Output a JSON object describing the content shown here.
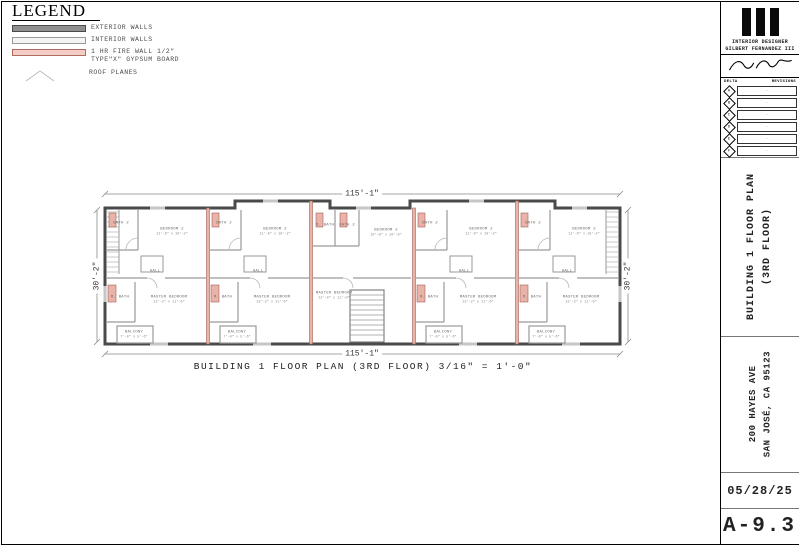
{
  "legend": {
    "title": "LEGEND",
    "items": [
      {
        "swatch": "exterior",
        "label": "EXTERIOR WALLS",
        "label2": ""
      },
      {
        "swatch": "interior",
        "label": "INTERIOR WALLS",
        "label2": ""
      },
      {
        "swatch": "firewall",
        "label": "1 HR FIRE WALL 1/2\"",
        "label2": "TYPE\"X\" GYPSUM BOARD"
      },
      {
        "swatch": "roof",
        "label": "ROOF PLANES",
        "label2": ""
      }
    ]
  },
  "plan": {
    "dim_top": "115'-1\"",
    "dim_bottom": "115'-1\"",
    "dim_left": "30'-2\"",
    "dim_right": "30'-2\"",
    "caption": "BUILDING 1 FLOOR PLAN (3RD FLOOR) 3/16\" = 1'-0\"",
    "rooms": [
      {
        "label": "BATH 2",
        "dim": "",
        "x": 33,
        "y": 38
      },
      {
        "label": "BEDROOM 2",
        "dim": "11'-6\" x 10'-2\"",
        "x": 84,
        "y": 46
      },
      {
        "label": "HALL",
        "dim": "",
        "x": 67,
        "y": 86
      },
      {
        "label": "M. BATH",
        "dim": "",
        "x": 32,
        "y": 112
      },
      {
        "label": "MASTER BEDROOM",
        "dim": "13'-2\" x 11'-6\"",
        "x": 81,
        "y": 114
      },
      {
        "label": "BALCONY",
        "dim": "7'-0\" x 5'-6\"",
        "x": 46,
        "y": 149
      },
      {
        "label": "BATH 2",
        "dim": "",
        "x": 136,
        "y": 38
      },
      {
        "label": "BEDROOM 2",
        "dim": "11'-6\" x 10'-2\"",
        "x": 187,
        "y": 46
      },
      {
        "label": "HALL",
        "dim": "",
        "x": 170,
        "y": 86
      },
      {
        "label": "M. BATH",
        "dim": "",
        "x": 135,
        "y": 112
      },
      {
        "label": "MASTER BEDROOM",
        "dim": "13'-2\" x 11'-6\"",
        "x": 184,
        "y": 114
      },
      {
        "label": "BALCONY",
        "dim": "7'-0\" x 5'-6\"",
        "x": 149,
        "y": 149
      },
      {
        "label": "M. BATH",
        "dim": "",
        "x": 237,
        "y": 40
      },
      {
        "label": "BATH 2",
        "dim": "",
        "x": 259,
        "y": 40
      },
      {
        "label": "BEDROOM 2",
        "dim": "10'-8\" x 10'-0\"",
        "x": 298,
        "y": 47
      },
      {
        "label": "MASTER BEDROOM",
        "dim": "12'-0\" x 11'-0\"",
        "x": 246,
        "y": 110
      },
      {
        "label": "BATH 2",
        "dim": "",
        "x": 342,
        "y": 38
      },
      {
        "label": "BEDROOM 2",
        "dim": "11'-6\" x 10'-2\"",
        "x": 393,
        "y": 46
      },
      {
        "label": "HALL",
        "dim": "",
        "x": 376,
        "y": 86
      },
      {
        "label": "M. BATH",
        "dim": "",
        "x": 341,
        "y": 112
      },
      {
        "label": "MASTER BEDROOM",
        "dim": "13'-2\" x 11'-6\"",
        "x": 390,
        "y": 114
      },
      {
        "label": "BALCONY",
        "dim": "7'-0\" x 5'-6\"",
        "x": 355,
        "y": 149
      },
      {
        "label": "BATH 2",
        "dim": "",
        "x": 445,
        "y": 38
      },
      {
        "label": "BEDROOM 2",
        "dim": "11'-6\" x 10'-2\"",
        "x": 496,
        "y": 46
      },
      {
        "label": "HALL",
        "dim": "",
        "x": 479,
        "y": 86
      },
      {
        "label": "M. BATH",
        "dim": "",
        "x": 444,
        "y": 112
      },
      {
        "label": "MASTER BEDROOM",
        "dim": "13'-2\" x 11'-6\"",
        "x": 493,
        "y": 114
      },
      {
        "label": "BALCONY",
        "dim": "7'-0\" x 5'-6\"",
        "x": 458,
        "y": 149
      }
    ]
  },
  "titleblock": {
    "firm_line1": "INTERIOR DESIGNER",
    "firm_line2": "GILBERT FERNANDEZ III",
    "delta_header": "DELTA",
    "revisions_header": "REVISIONS",
    "revision_rows": [
      {
        "letter": "A",
        "note": "-"
      },
      {
        "letter": "B",
        "note": "-"
      },
      {
        "letter": "C",
        "note": "-"
      },
      {
        "letter": "D",
        "note": "-"
      },
      {
        "letter": "E",
        "note": "-"
      },
      {
        "letter": "F",
        "note": "-"
      }
    ],
    "sheet_title_line1": "BUILDING 1 FLOOR PLAN",
    "sheet_title_line2": "(3RD FLOOR)",
    "address_line1": "200 HAYES AVE",
    "address_line2": "SAN JOSÉ, CA 95123",
    "date": "05/28/25",
    "sheet_number": "A-9.3"
  },
  "colors": {
    "exterior_wall": "#4a4a4a",
    "interior_wall": "#9a9a9a",
    "firewall_fill": "#eab3a9",
    "firewall_stroke": "#a06258",
    "dimension_line": "#888888"
  }
}
